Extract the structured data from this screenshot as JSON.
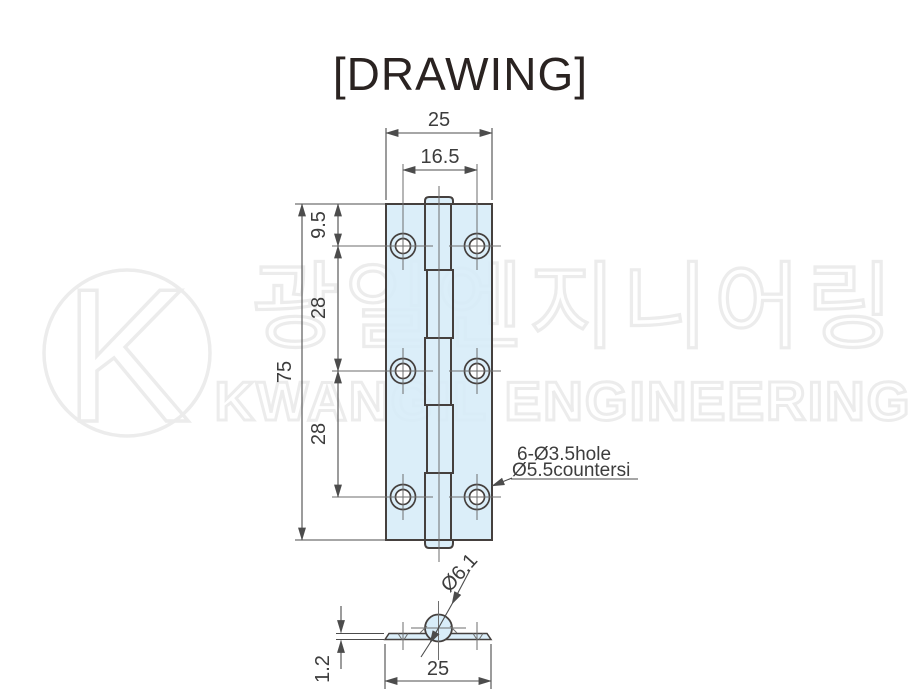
{
  "title": "[DRAWING]",
  "watermark": {
    "logo_letter": "K",
    "korean_text": "광일엔지니어링",
    "english_text": "KWANGIL ENGINEERING"
  },
  "colors": {
    "body_fill": "#d6ecf8",
    "outline": "#45403e",
    "dimension_lines": "#4c4c4c",
    "dimension_text": "#3d3d3d",
    "watermark_stroke": "#ececec",
    "background": "#ffffff",
    "title_text": "#2a2321"
  },
  "front_view": {
    "width": "25",
    "hole_span": "16.5",
    "height": "75",
    "top_offset": "9.5",
    "hole_pitch_upper": "28",
    "hole_pitch_lower": "28",
    "hole_note_line1": "6-Ø3.5hole",
    "hole_note_line2": "Ø5.5countersi"
  },
  "section_view": {
    "knuckle_diameter": "Ø6.1",
    "width": "25",
    "plate_thickness": "1.2"
  }
}
